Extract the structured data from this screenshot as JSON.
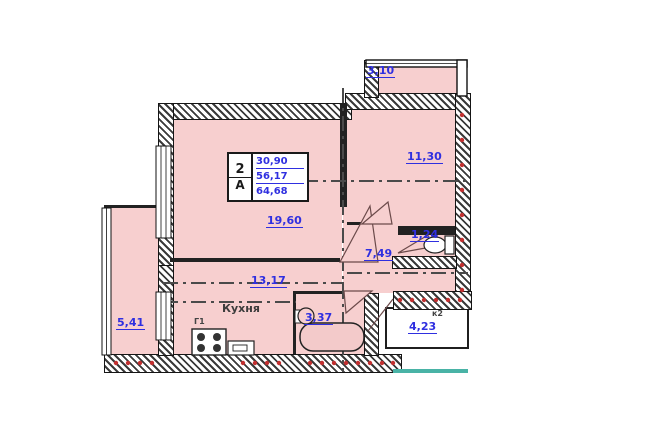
{
  "plan": {
    "title": "apartment-floor-plan",
    "stamp": {
      "rooms_count": "2",
      "type_letter": "А",
      "living_area": "30,90",
      "apartment_area": "56,17",
      "total_area": "64,68"
    },
    "rooms": {
      "living": {
        "area": "19,60"
      },
      "bedroom": {
        "area": "11,30"
      },
      "kitchen": {
        "label": "Кухня",
        "area": "13,17"
      },
      "hall": {
        "area": "7,49"
      },
      "wc": {
        "area": "1,24"
      },
      "bath": {
        "area": "3,37"
      },
      "balcony_left": {
        "area": "5,41"
      },
      "balcony_top": {
        "area": "3,10"
      },
      "balcony_right": {
        "area": "4,23",
        "mark": "к2"
      }
    },
    "marks": {
      "stove": "Г1"
    },
    "colors": {
      "room_fill": "#f7cfcf",
      "dimension_text": "#2f2fe0",
      "wall": "#1a1a1a",
      "tick_red": "#c23030",
      "accent_teal": "#49b3a6"
    }
  }
}
